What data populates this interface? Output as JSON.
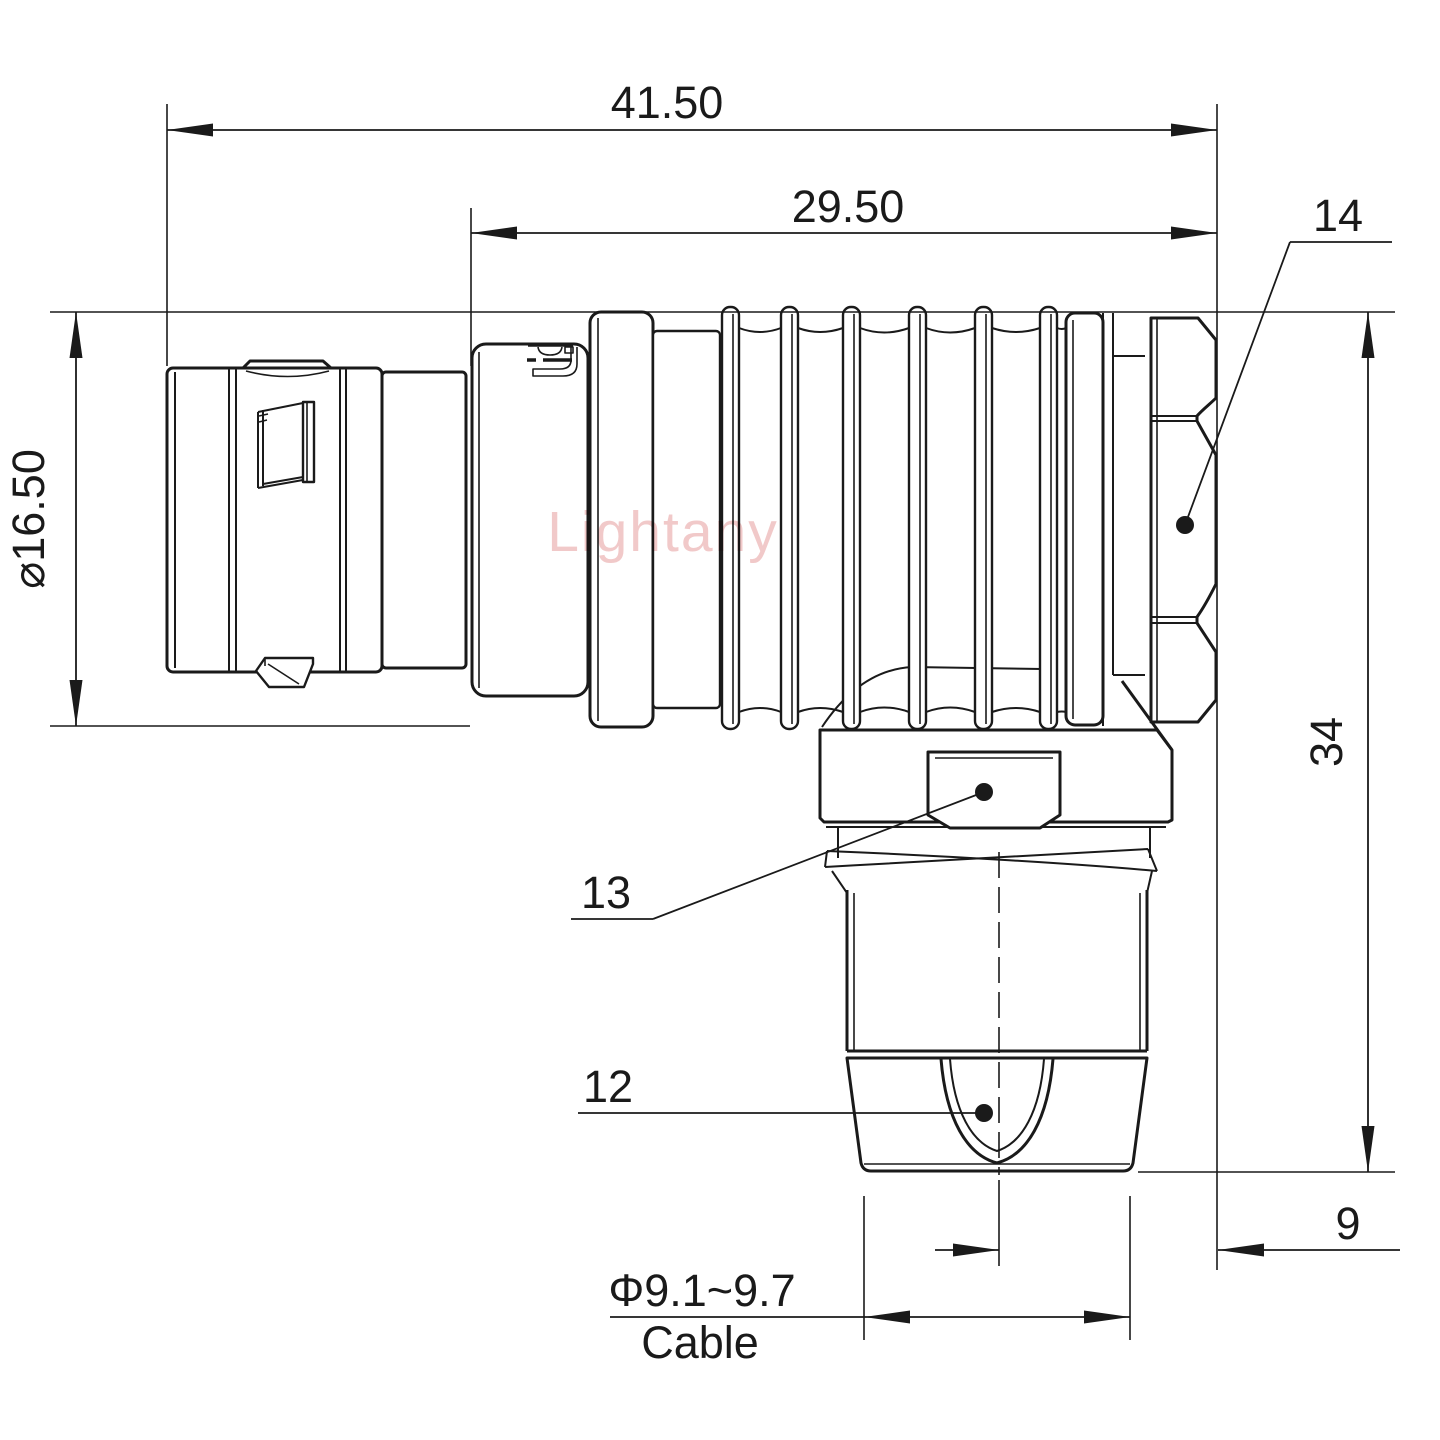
{
  "drawing": {
    "type": "connector elbow plug technical drawing",
    "units": "mm",
    "watermark": {
      "text": "Lightany",
      "color": "#f0c3c3"
    },
    "colors": {
      "line": "#1a1a1a",
      "background": "#ffffff"
    },
    "dimensions": {
      "overall_length": "41.50",
      "front_length": "29.50",
      "plug_diameter": "⌀16.50",
      "height": "34",
      "cable_axis_offset": "9",
      "cable_diameter_range": "Φ9.1~9.7",
      "cable_label": "Cable"
    },
    "callouts": {
      "coupling_nut": "14",
      "spanner_flat": "13",
      "cable_clamp": "12"
    }
  }
}
